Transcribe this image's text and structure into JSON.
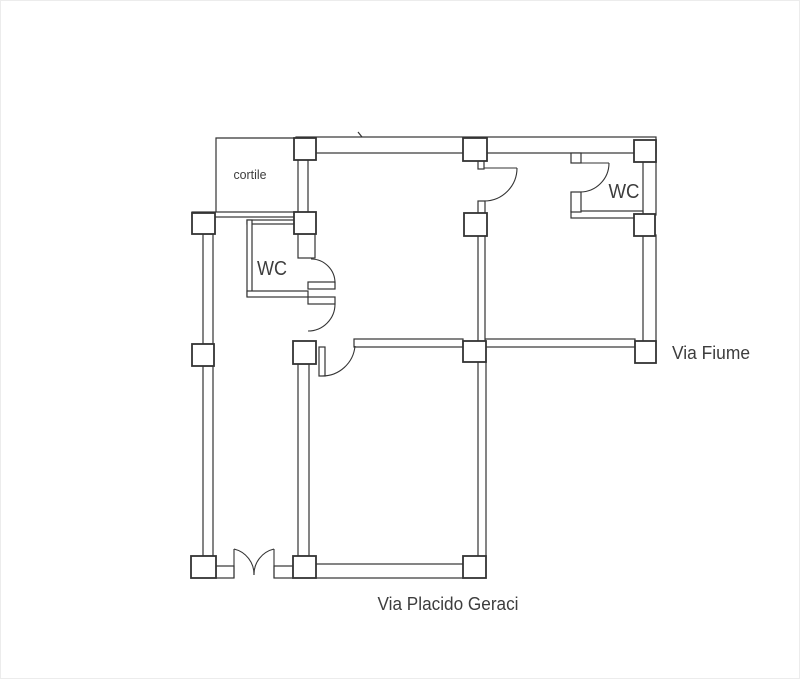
{
  "floorplan": {
    "title": "apartment floor plan",
    "labels": {
      "courtyard": "cortile",
      "wc_left": "WC",
      "wc_right": "WC",
      "street_right": "Via Fiume",
      "street_bottom": "Via Placido Geraci"
    },
    "colors": {
      "wall": "#333333",
      "text": "#3d3d3d",
      "background": "#ffffff",
      "frame": "#ececec"
    }
  }
}
